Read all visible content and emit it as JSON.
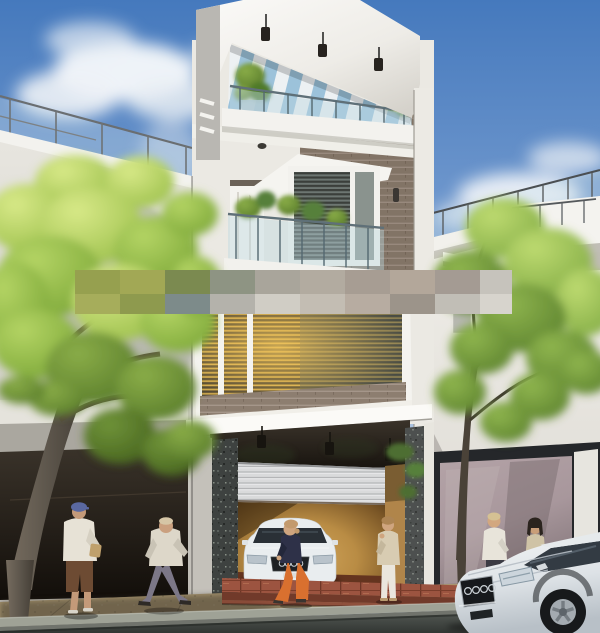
{
  "meta": {
    "title": "Modern three-storey townhouse — exterior 3D architectural rendering",
    "width_px": 600,
    "height_px": 633
  },
  "palette": {
    "sky_top": "#4579bd",
    "sky_horizon": "#e3eaf1",
    "cloud_white": "#f6f8fa",
    "wall_white": "#efede7",
    "wall_shaded": "#d6d4cd",
    "roof_white": "#f8f7f4",
    "brick_tile": "#8d7e70",
    "blind_slat": "#433c30",
    "blind_glow": "#d8ae52",
    "pergola_louver": "#edf1f3",
    "pergola_sky": "#9cc2da",
    "glass_tint": "#bcd8e0",
    "steel_rail": "#5f7078",
    "canopy_black": "#1f1a14",
    "shutter_grey": "#d9dadb",
    "stone_dark": "#3e4240",
    "foliage_bright": "#c6dd6e",
    "foliage_mid": "#9cc04c",
    "foliage_deep": "#5a7d2c",
    "trunk_brown": "#5d564c"
  },
  "scene": {
    "setting": "Sunny street view of a modern white townhouse with rooftop terrace, flanked by neighbouring buildings, street trees, pedestrians and two white sedans",
    "sky": {
      "description": "blue sky with white cumulus clouds upper-left and right"
    },
    "buildings": {
      "main_building": {
        "storeys": 3,
        "roof": {
          "type": "flat white slab with louvred pergola over roof terrace",
          "pendant_lamps": 3,
          "louver_color": "#edf1f3",
          "sky_gap_color": "#9cc2da"
        },
        "walls": {
          "white": "#efede7",
          "brick_tile": "#8d7e70"
        },
        "third_floor": {
          "balcony": "glass balustrade with potted plants",
          "window": "bay window with dark venetian blinds",
          "door": "white panel door",
          "wall_sconce": true,
          "ceiling_downlight": true
        },
        "second_floor": {
          "window": "wide picture window with venetian blinds and warm interior light",
          "glow_color": "#d8ae52",
          "sill": "brick tile band"
        },
        "ground_floor": {
          "garage_door": "half-open roller shutter",
          "shutter_color": "#d9dadb",
          "interior_glow": "#c89a50",
          "reveal": "#b0854a",
          "columns": "dark granite cladding",
          "step_tile": "#9c5440",
          "step_riser": "#713a2a",
          "pendant_lamps": 3
        }
      },
      "left_building": {
        "description": "white neighbour building with rooftop glass railing and dark ground-floor opening",
        "wall": "#dcdad3"
      },
      "right_building": {
        "description": "white neighbour building with rooftop railing, projecting balcony and mauve glass storefront",
        "storefront_glass": "#a8979c",
        "storefront_frame": "#25272a",
        "curb_pillar": "#e7e5df"
      }
    },
    "trees": [
      {
        "id": "large-tree-left",
        "foliage": [
          "#c9de72",
          "#9cc04c",
          "#6e9634",
          "#4f7427"
        ],
        "trunk": "#5d564c"
      },
      {
        "id": "street-tree-right",
        "foliage": [
          "#a8cb61",
          "#79a542",
          "#4f7a2c"
        ],
        "trunk": "#4a4238"
      }
    ],
    "people": [
      {
        "id": "man-blue-cap",
        "pose": "standing on left sidewalk holding a bag",
        "cap_color": "#5a68a0",
        "shirt_color": "#e7e2d6",
        "shorts_color": "#6d4b33",
        "skin": "#c49a79"
      },
      {
        "id": "man-walking",
        "pose": "striding right along sidewalk",
        "shirt_color": "#ddd7c9",
        "pants_color": "#7c7787",
        "skin": "#caa07f"
      },
      {
        "id": "woman-orange-trousers",
        "pose": "walking left in front of garage",
        "top_color": "#2e3148",
        "pants_color": "#d9702f",
        "hair": "#c39a6d",
        "skin": "#cfa57f"
      },
      {
        "id": "woman-cream-suit",
        "pose": "standing facing the house, phone to ear",
        "jacket_color": "#d8ccb2",
        "pants_color": "#eae6dd",
        "hair": "#ad8554",
        "skin": "#cfa57f"
      },
      {
        "id": "man-white-shirt-right",
        "pose": "standing near storefront",
        "shirt_color": "#e8e4da",
        "pants_color": "#3b3b44",
        "hair": "#d5c193",
        "skin": "#d2a77f"
      },
      {
        "id": "woman-dark-hair-right",
        "pose": "standing facing left",
        "top_color": "#cfc3a6",
        "hair": "#2b241e",
        "skin": "#c99e79"
      }
    ],
    "vehicles": [
      {
        "id": "sedan-in-garage",
        "description": "white sedan parked inside garage, front view, four-ring badge",
        "body_color": "#e9edef"
      },
      {
        "id": "sedan-at-curb",
        "description": "white sedan parked at curb bottom-right, front three-quarter view, four-ring badge",
        "body_color": "#dde2e6"
      }
    ],
    "street": {
      "sidewalk": "#a8956f",
      "sidewalk_shaded": "#6e624d",
      "curb": "#9fa296",
      "asphalt": "#494e49"
    },
    "watermark_band": {
      "description": "pixelated mosaic censor strip across the façade",
      "blocks": [
        {
          "x": 75,
          "y": 270,
          "w": 45,
          "h": 24,
          "c": "#96a04f"
        },
        {
          "x": 120,
          "y": 270,
          "w": 45,
          "h": 24,
          "c": "#a2a855"
        },
        {
          "x": 165,
          "y": 270,
          "w": 45,
          "h": 24,
          "c": "#7b8a50"
        },
        {
          "x": 210,
          "y": 270,
          "w": 45,
          "h": 24,
          "c": "#8e9483"
        },
        {
          "x": 255,
          "y": 270,
          "w": 45,
          "h": 24,
          "c": "#a9a59b"
        },
        {
          "x": 300,
          "y": 270,
          "w": 45,
          "h": 24,
          "c": "#b2aba0"
        },
        {
          "x": 345,
          "y": 270,
          "w": 45,
          "h": 24,
          "c": "#a79d93"
        },
        {
          "x": 390,
          "y": 270,
          "w": 45,
          "h": 24,
          "c": "#b3a79a"
        },
        {
          "x": 435,
          "y": 270,
          "w": 45,
          "h": 24,
          "c": "#a49b93"
        },
        {
          "x": 480,
          "y": 270,
          "w": 32,
          "h": 24,
          "c": "#c6c3bc"
        },
        {
          "x": 75,
          "y": 294,
          "w": 45,
          "h": 20,
          "c": "#a6ad5b"
        },
        {
          "x": 120,
          "y": 294,
          "w": 45,
          "h": 20,
          "c": "#8e9a4e"
        },
        {
          "x": 165,
          "y": 294,
          "w": 45,
          "h": 20,
          "c": "#7d8b8a"
        },
        {
          "x": 210,
          "y": 294,
          "w": 45,
          "h": 20,
          "c": "#b4b2ab"
        },
        {
          "x": 255,
          "y": 294,
          "w": 45,
          "h": 20,
          "c": "#d0cdc5"
        },
        {
          "x": 300,
          "y": 294,
          "w": 45,
          "h": 20,
          "c": "#c3bdb3"
        },
        {
          "x": 345,
          "y": 294,
          "w": 45,
          "h": 20,
          "c": "#b7aca1"
        },
        {
          "x": 390,
          "y": 294,
          "w": 45,
          "h": 20,
          "c": "#9c948a"
        },
        {
          "x": 435,
          "y": 294,
          "w": 45,
          "h": 20,
          "c": "#c1beb6"
        },
        {
          "x": 480,
          "y": 294,
          "w": 32,
          "h": 20,
          "c": "#d7d4cd"
        }
      ]
    }
  }
}
